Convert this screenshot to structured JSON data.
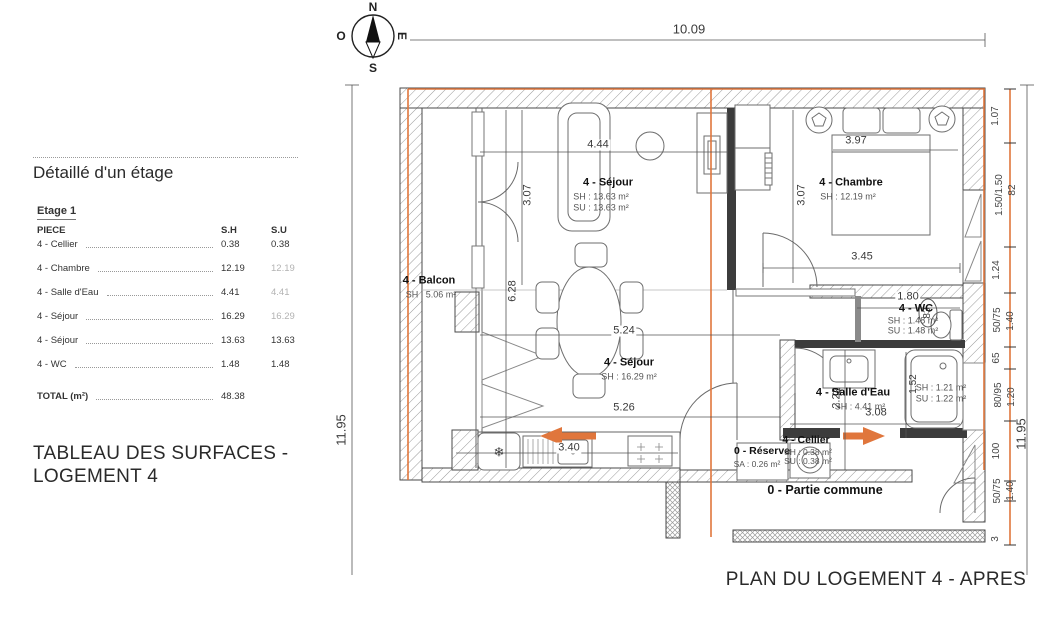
{
  "surface_table": {
    "title": "Détaillé d'un étage",
    "floor_label": "Etage 1",
    "columns": {
      "piece": "PIECE",
      "sh": "S.H",
      "su": "S.U"
    },
    "rows": [
      {
        "piece": "4 - Cellier",
        "sh": "0.38",
        "su": "0.38"
      },
      {
        "piece": "4 - Chambre",
        "sh": "12.19",
        "su": "12.19"
      },
      {
        "piece": "4 - Salle d'Eau",
        "sh": "4.41",
        "su": "4.41"
      },
      {
        "piece": "4 - Séjour",
        "sh": "16.29",
        "su": "16.29"
      },
      {
        "piece": "4 - Séjour",
        "sh": "13.63",
        "su": "13.63"
      },
      {
        "piece": "4 - WC",
        "sh": "1.48",
        "su": "1.48"
      }
    ],
    "total_label": "TOTAL (m²)",
    "total_value": "48.38",
    "caption_line1": "TABLEAU DES SURFACES -",
    "caption_line2": "LOGEMENT 4"
  },
  "compass": {
    "north": "N",
    "south": "S",
    "west": "O",
    "east": "E"
  },
  "plan": {
    "title": "PLAN DU LOGEMENT 4 - APRES",
    "rooms": {
      "sejour_top": {
        "name": "4 - Séjour",
        "sh": "SH : 13.63 m²",
        "su": "SU : 13.63 m²"
      },
      "chambre": {
        "name": "4 - Chambre",
        "sh": "SH : 12.19 m²"
      },
      "balcon": {
        "name": "4 - Balcon",
        "sh": "SH : 5.06 m²"
      },
      "sejour_bottom": {
        "name": "4 - Séjour",
        "sh": "SH : 16.29 m²"
      },
      "wc": {
        "name": "4 - WC",
        "sh": "SH : 1.48 m²",
        "su": "SU : 1.48 m²"
      },
      "salle_eau": {
        "name": "4 - Salle d'Eau",
        "sh": "SH : 4.41 m²"
      },
      "baignoire": {
        "sh": "SH : 1.21 m²",
        "su": "SU : 1.22 m²"
      },
      "reserve": {
        "name": "0 - Réserve",
        "sa": "SA : 0.26 m²"
      },
      "cellier": {
        "name": "4 - Cellier",
        "sh": "SH : 0.38 m²",
        "su": "SU : 0.38 m²"
      },
      "partie_commune": {
        "name": "0 - Partie commune"
      }
    },
    "dimensions": {
      "top_width": "10.09",
      "left_height": "11.95",
      "right_height": "11.95",
      "sejour_width": "4.44",
      "sejour_depth": "3.07",
      "chambre_bed_width": "3.97",
      "chambre_depth": "3.07",
      "chambre_width": "3.45",
      "sejour2_height": "6.28",
      "sejour2_width": "5.24",
      "sejour2_width2": "5.26",
      "wc_width": "1.80",
      "wc_door": "83",
      "salle_eau_height": "2.22",
      "salle_eau_width": "3.08",
      "baignoire_length": "1.52",
      "kitchen_width": "3.40",
      "right_chain": [
        "1.07",
        "1.50/1.50",
        "82",
        "1.24",
        "50/75",
        "1.40",
        "65",
        "80/95",
        "1.20",
        "100",
        "50/75",
        "1.40",
        "3"
      ]
    }
  },
  "icons": {
    "snowflake": "❄"
  },
  "colors": {
    "boundary_orange": "#e0763c",
    "line_dark": "#3c3c3c"
  }
}
